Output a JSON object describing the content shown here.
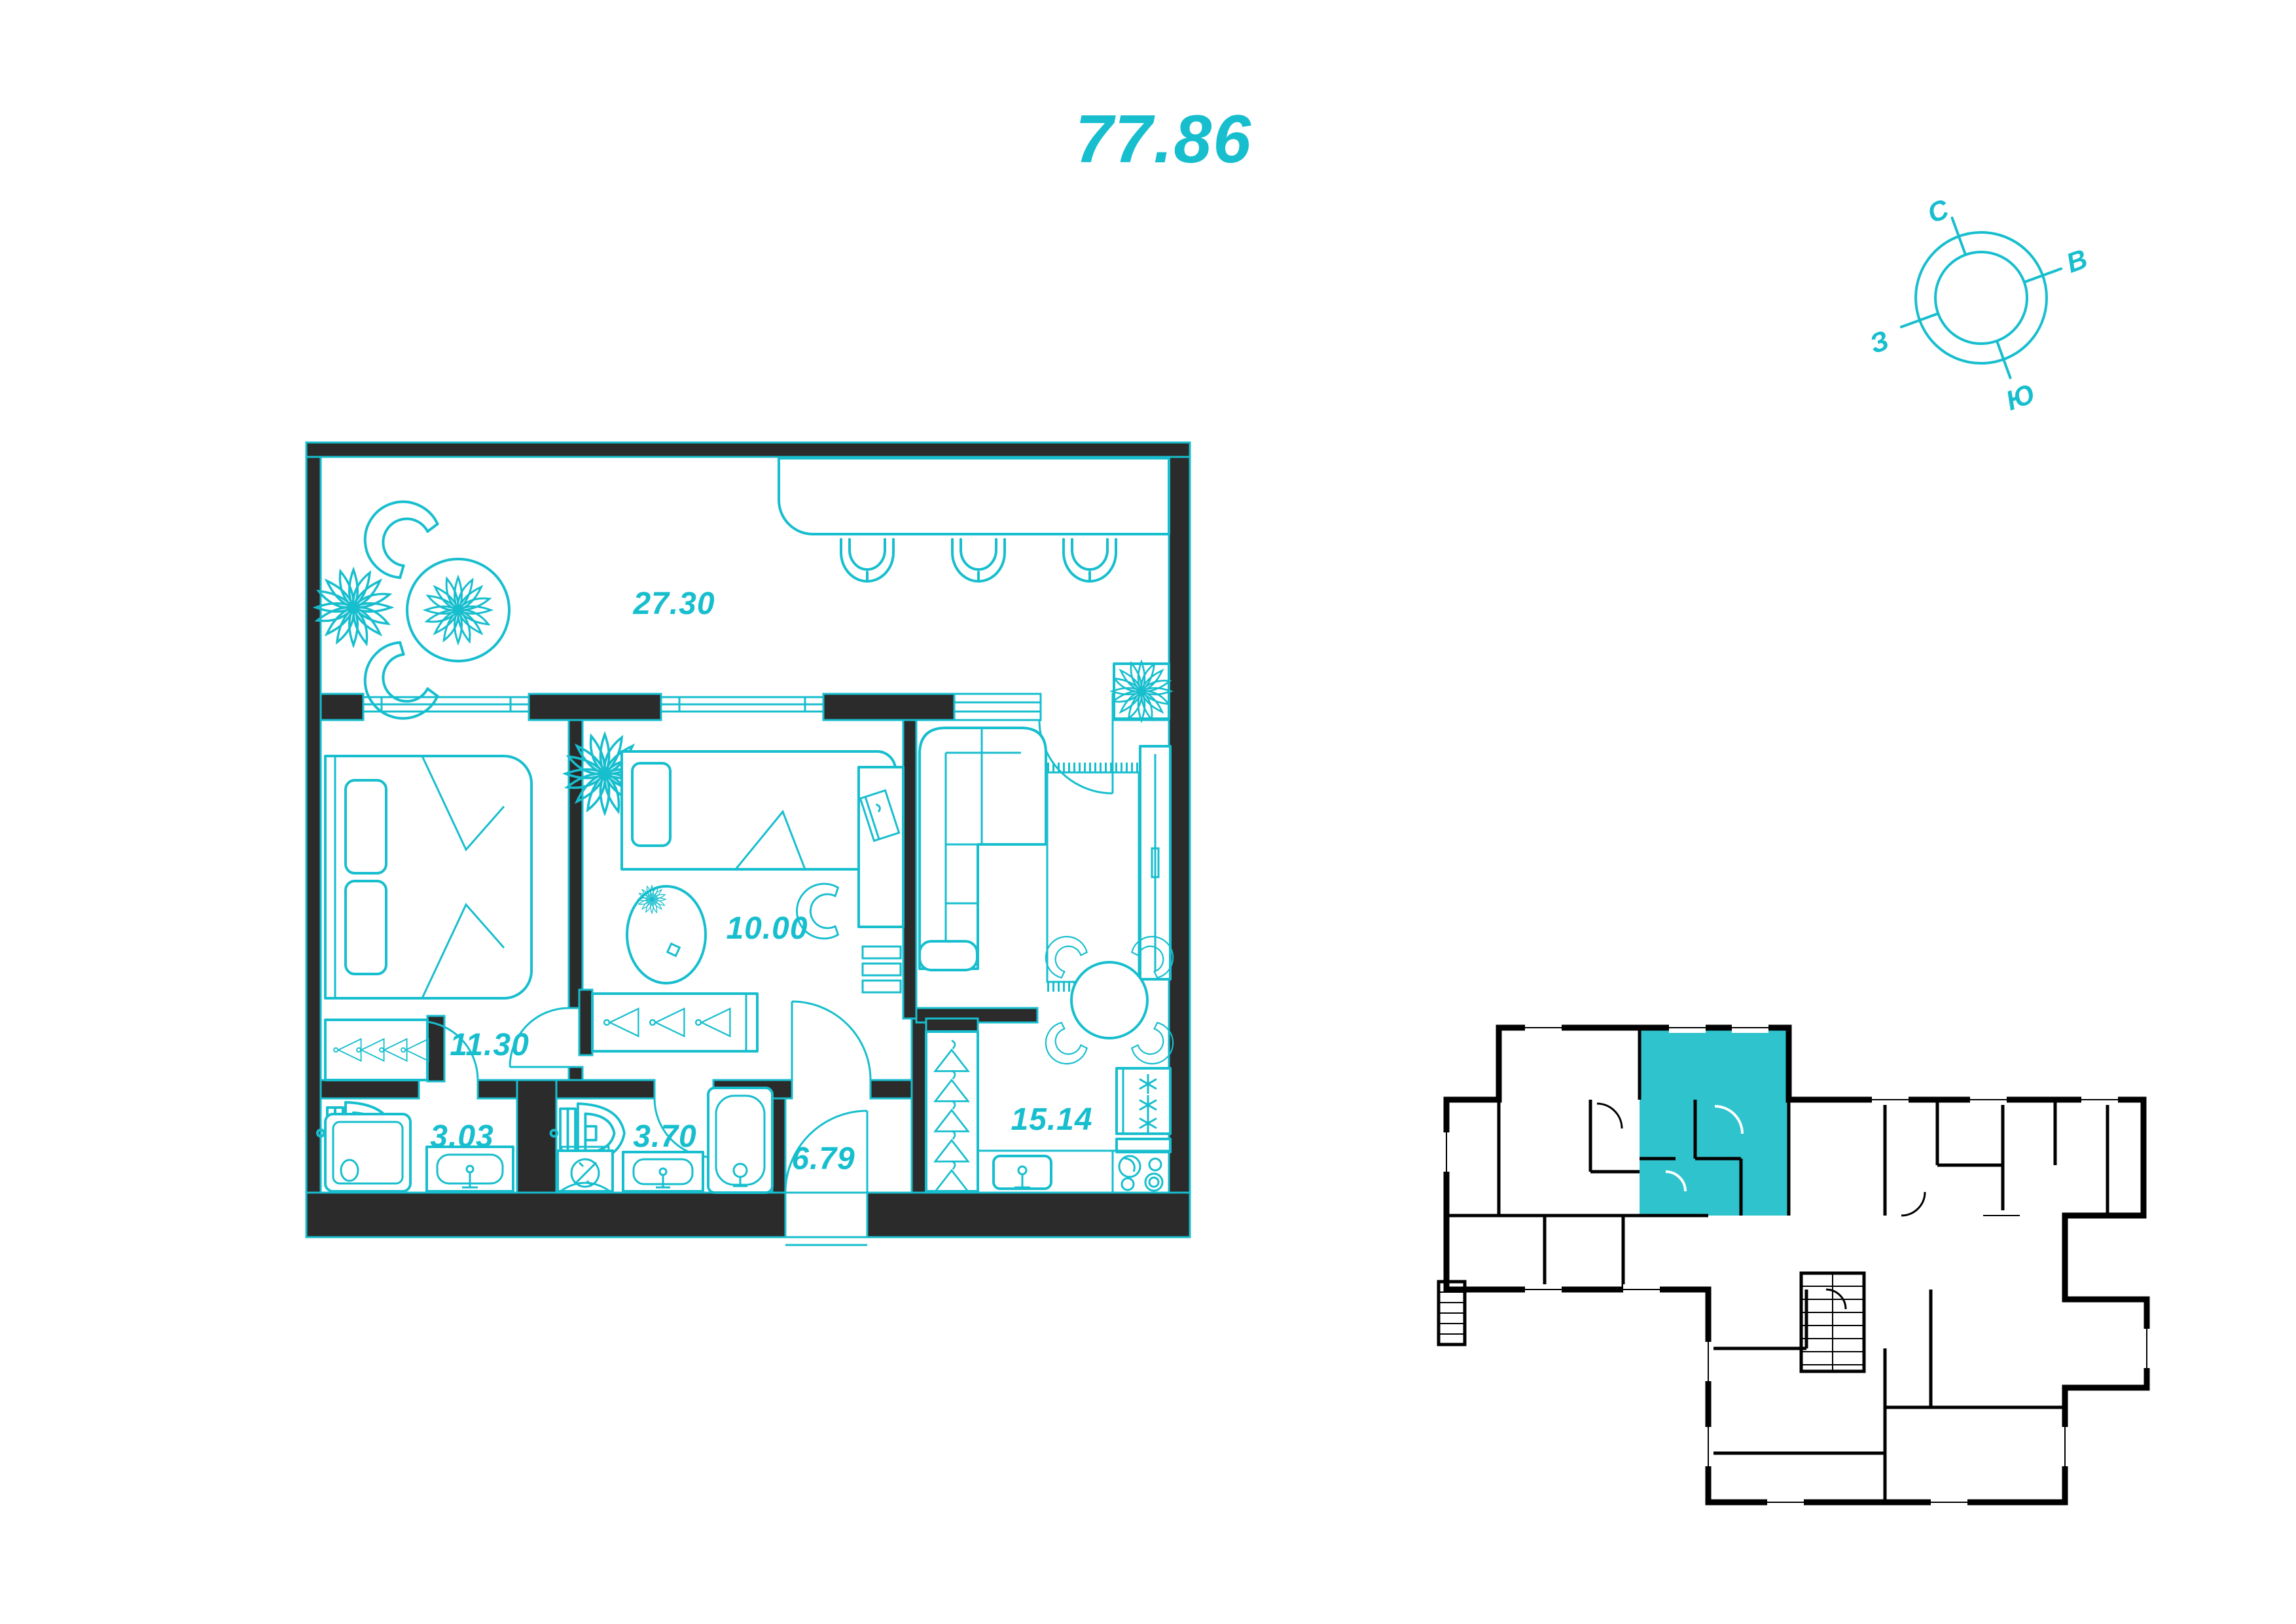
{
  "page": {
    "background": "#ffffff"
  },
  "colors": {
    "accent": "#17bece",
    "wall_dark": "#2b2b2b",
    "keyplan_black": "#000000",
    "highlight_fill": "#2fc3cd"
  },
  "title": {
    "total_area": "77.86"
  },
  "compass": {
    "north": "С",
    "east": "В",
    "south": "Ю",
    "west": "З"
  },
  "floorplan": {
    "rooms": [
      {
        "name": "living-room",
        "area": "27.30"
      },
      {
        "name": "bedroom",
        "area": "11.30"
      },
      {
        "name": "room",
        "area": "10.00"
      },
      {
        "name": "kitchen-dining",
        "area": "15.14"
      },
      {
        "name": "bathroom",
        "area": "3.03"
      },
      {
        "name": "bathroom-2",
        "area": "3.70"
      },
      {
        "name": "hallway",
        "area": "6.79"
      }
    ]
  },
  "key_plan": {
    "highlighted_unit": "selected"
  }
}
